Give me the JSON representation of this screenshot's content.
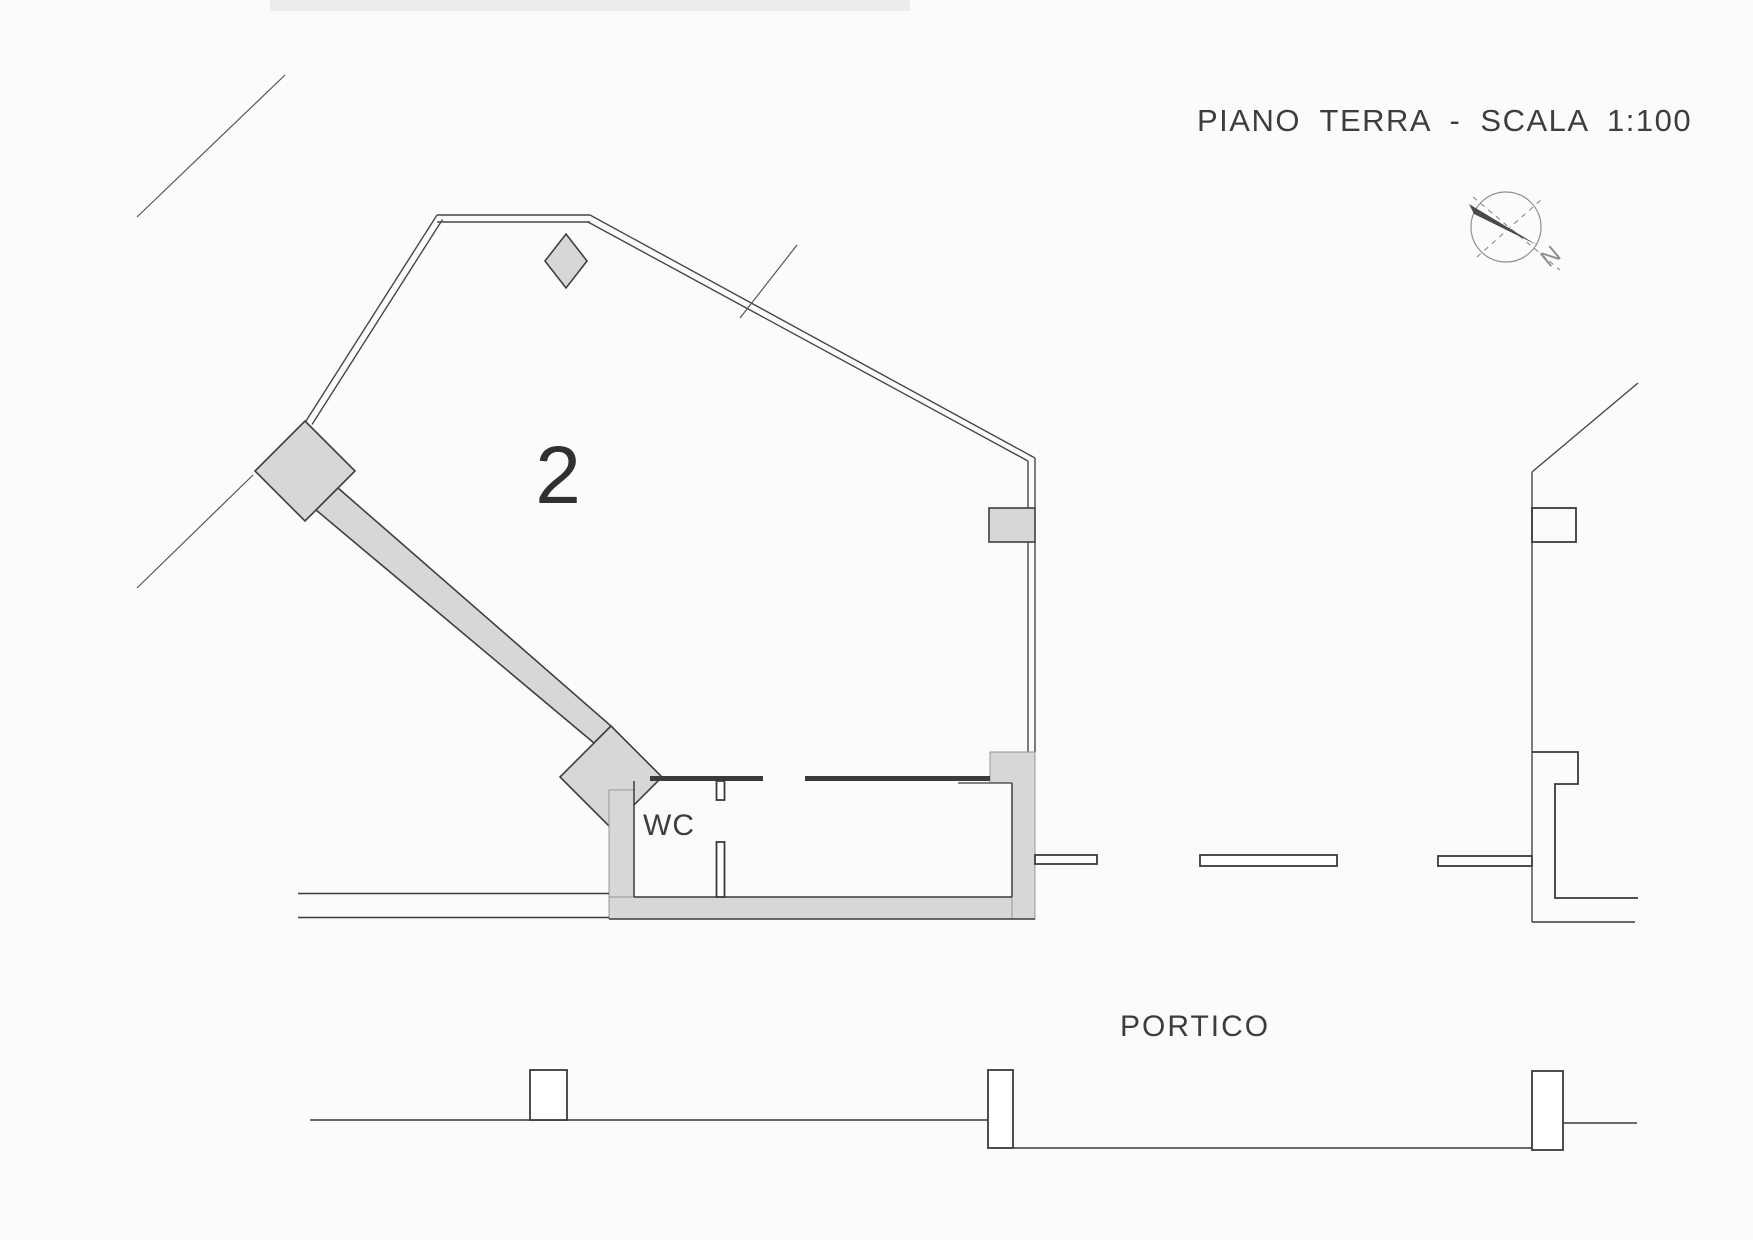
{
  "document": {
    "title": "PIANO TERRA -  SCALA 1:100",
    "floor_label": "PIANO TERRA",
    "scale": "1:100"
  },
  "plan": {
    "room_number": "2",
    "wc_label": "WC",
    "portico_label": "PORTICO"
  },
  "compass": {
    "north_label": "N"
  },
  "colors": {
    "paper": "#fbfbfa",
    "line": "#3a3a3a",
    "wall": "#d7d7d7",
    "compass": "#909090",
    "text": "#3d3d3d"
  }
}
